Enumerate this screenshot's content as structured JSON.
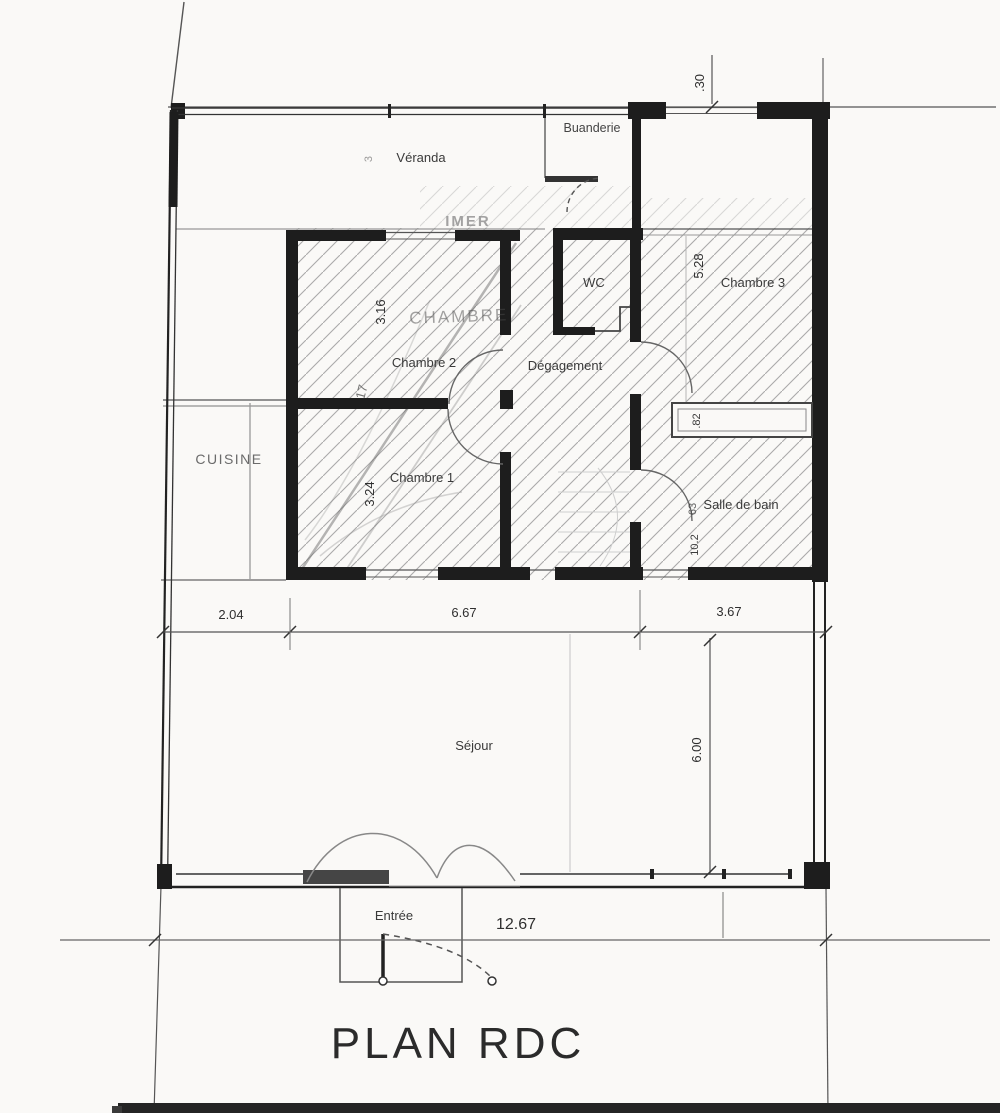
{
  "document": {
    "title": "PLAN RDC",
    "stamp": "IMER"
  },
  "rooms": [
    {
      "label": "Véranda"
    },
    {
      "label": "Buanderie"
    },
    {
      "label": "WC"
    },
    {
      "label": "CHAMBRE"
    },
    {
      "label": "Chambre 2"
    },
    {
      "label": "Dégagement"
    },
    {
      "label": "Chambre 3"
    },
    {
      "label": "CUISINE"
    },
    {
      "label": "Chambre 1"
    },
    {
      "label": "Salle de bain"
    },
    {
      "label": "Séjour"
    },
    {
      "label": "Entrée"
    }
  ],
  "dimensions": {
    "horizontal": [
      {
        "text": "2.04"
      },
      {
        "text": "6.67"
      },
      {
        "text": "3.67"
      },
      {
        "text": "12.67"
      }
    ],
    "vertical": [
      {
        "text": ".30"
      },
      {
        "text": "5.28"
      },
      {
        "text": "3.16"
      },
      {
        "text": "17"
      },
      {
        "text": "3.24"
      },
      {
        "text": ".82"
      },
      {
        "text": "63"
      },
      {
        "text": "10.2"
      },
      {
        "text": "6.00"
      },
      {
        "text": "3"
      }
    ]
  },
  "colors": {
    "paper": "#faf9f7",
    "wall_ink": "#1d1d1d",
    "line": "#555555",
    "hatch": "#8f8f8f"
  }
}
